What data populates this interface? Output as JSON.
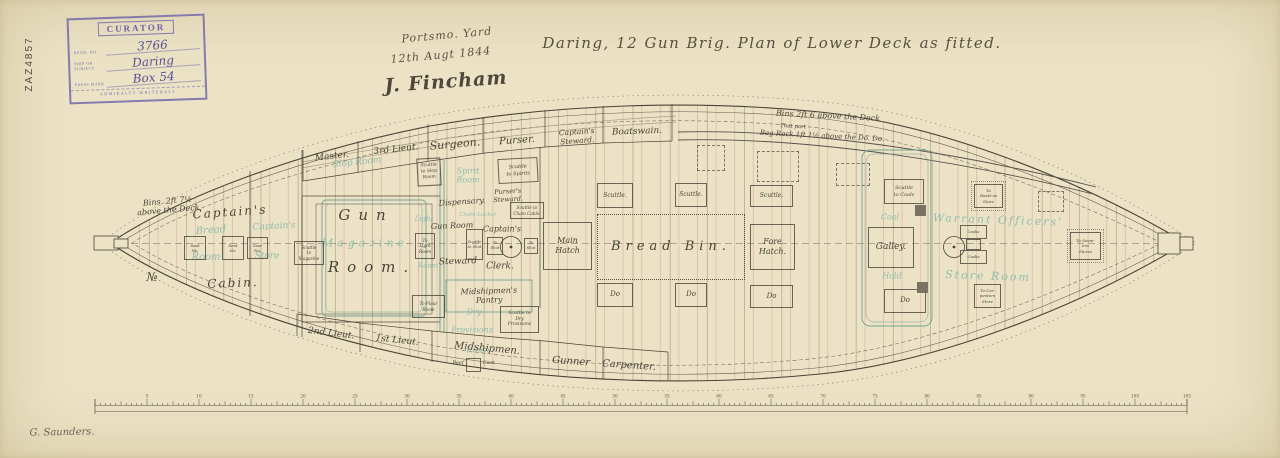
{
  "archive_stamp": {
    "title": "CURATOR",
    "fields": [
      {
        "label": "Regd. No.",
        "value": "3766"
      },
      {
        "label": "Ship or Subject",
        "value": "Daring"
      },
      {
        "label": "Press Mark",
        "value": "Box 54"
      }
    ],
    "footer": "ADMIRALTY WHITEHALL"
  },
  "margin": {
    "catalog_ref": "ZAZ4857",
    "surveyor_signature": "G. Saunders."
  },
  "title_block": {
    "yard": "Portsmo. Yard",
    "date": "12th Augt 1844",
    "signature": "J. Fincham",
    "main_title": "Daring, 12 Gun Brig.  Plan of Lower Deck as fitted."
  },
  "notes": {
    "stern_bins": "Bins. 2ft 7½\nabove the Deck",
    "stern_mark": "№",
    "bow_bins_1": "Bins 2ft 6 above the Deck",
    "bow_bins_2": "That part",
    "bow_bins_3": "Bag Rack 1ft 1½ above the Do. Do."
  },
  "deck_labels": {
    "master": "Master.",
    "third_lieut": "3rd Lieut.",
    "surgeon": "Surgeon.",
    "purser": "Purser.",
    "captains_steward": "Captain's\nSteward.",
    "boatswain": "Boatswain.",
    "captains": "Captain's",
    "cabin": "Cabin.",
    "gun": "Gun",
    "room": "Room.",
    "dispensary": "Dispensary.",
    "pursers_steward": "Purser's\nSteward.",
    "gun_room_steward_1": "Gun Room",
    "gun_room_steward_2": "Steward",
    "captains_clerk_1": "Captain's",
    "captains_clerk_2": "Clerk.",
    "midshipmens_pantry": "Midshipmen's\nPantry",
    "second_lieut": "2nd Lieut.",
    "first_lieut": "1st Lieut.",
    "midshipmen": "Midshipmen.",
    "beef_1": "Beef",
    "beef_2": "Cask",
    "gunner": "Gunner",
    "carpenter": "Carpenter.",
    "main_hatch": "Main\nHatch",
    "bread_bin": "Bread Bin.",
    "fore_hatch": "Fore\nHatch.",
    "galley": "Galley.",
    "scuttle": "Scuttle.",
    "ditto": "Do",
    "scuttle_slop": "Scuttle\nto Slop\nRoom",
    "scuttle_spirits": "Scuttle\nto Spirits",
    "scuttle_chain": "Scuttle to\nChain Cable.",
    "scuttle_magazine": "Scuttle\nto\nMagazine",
    "to_light_room": "To\nLight\nRoom",
    "to_flour_room": "To Flour\nRoom",
    "scuttle_shot": "Scuttle\nto Shot",
    "to_shot": "To\nShot",
    "scuttle_dry_provisions": "Scuttle to\nDry\nProvisions",
    "scuttle_coals": "Scuttle\nto Coals",
    "to_boatswains_store": "To\nBoats'ns\nStore",
    "to_carpenters_store": "To Car-\npenters\nStore",
    "to_seamens_stores": "To Seam-\nens\nStores",
    "casks": "Casks",
    "seat": "Seat\nNo."
  },
  "below_deck_labels": {
    "slop_room": "Slop Room",
    "spirit_room": "Spirit\nRoom",
    "bread": "Bread",
    "bread_room_2": "Room",
    "captains_store_1": "Captain's",
    "captains_store_2": "Store",
    "magazine": "Magazine",
    "light": "Light",
    "light_room_2": "Room",
    "chain_locker": "Chain Locker",
    "dry_1": "Dry",
    "dry_2": "Provisions",
    "dry_3": "Room",
    "coal": "Coal",
    "hold": "Hold",
    "warrant_officers": "Warrant Officers'",
    "store_room": "Store Room"
  },
  "scale_bar": {
    "unit_labels": [
      "5",
      "10",
      "15",
      "20",
      "25",
      "30",
      "35",
      "40",
      "45",
      "50",
      "55",
      "60",
      "65",
      "70",
      "75",
      "80",
      "85",
      "90",
      "95",
      "100",
      "105"
    ]
  },
  "palette": {
    "paper": "#ece3c6",
    "ink": "#4a4437",
    "below_deck_green": "#93bcab",
    "station_red": "#d9aca2",
    "stamp_violet": "#6b62a8"
  }
}
